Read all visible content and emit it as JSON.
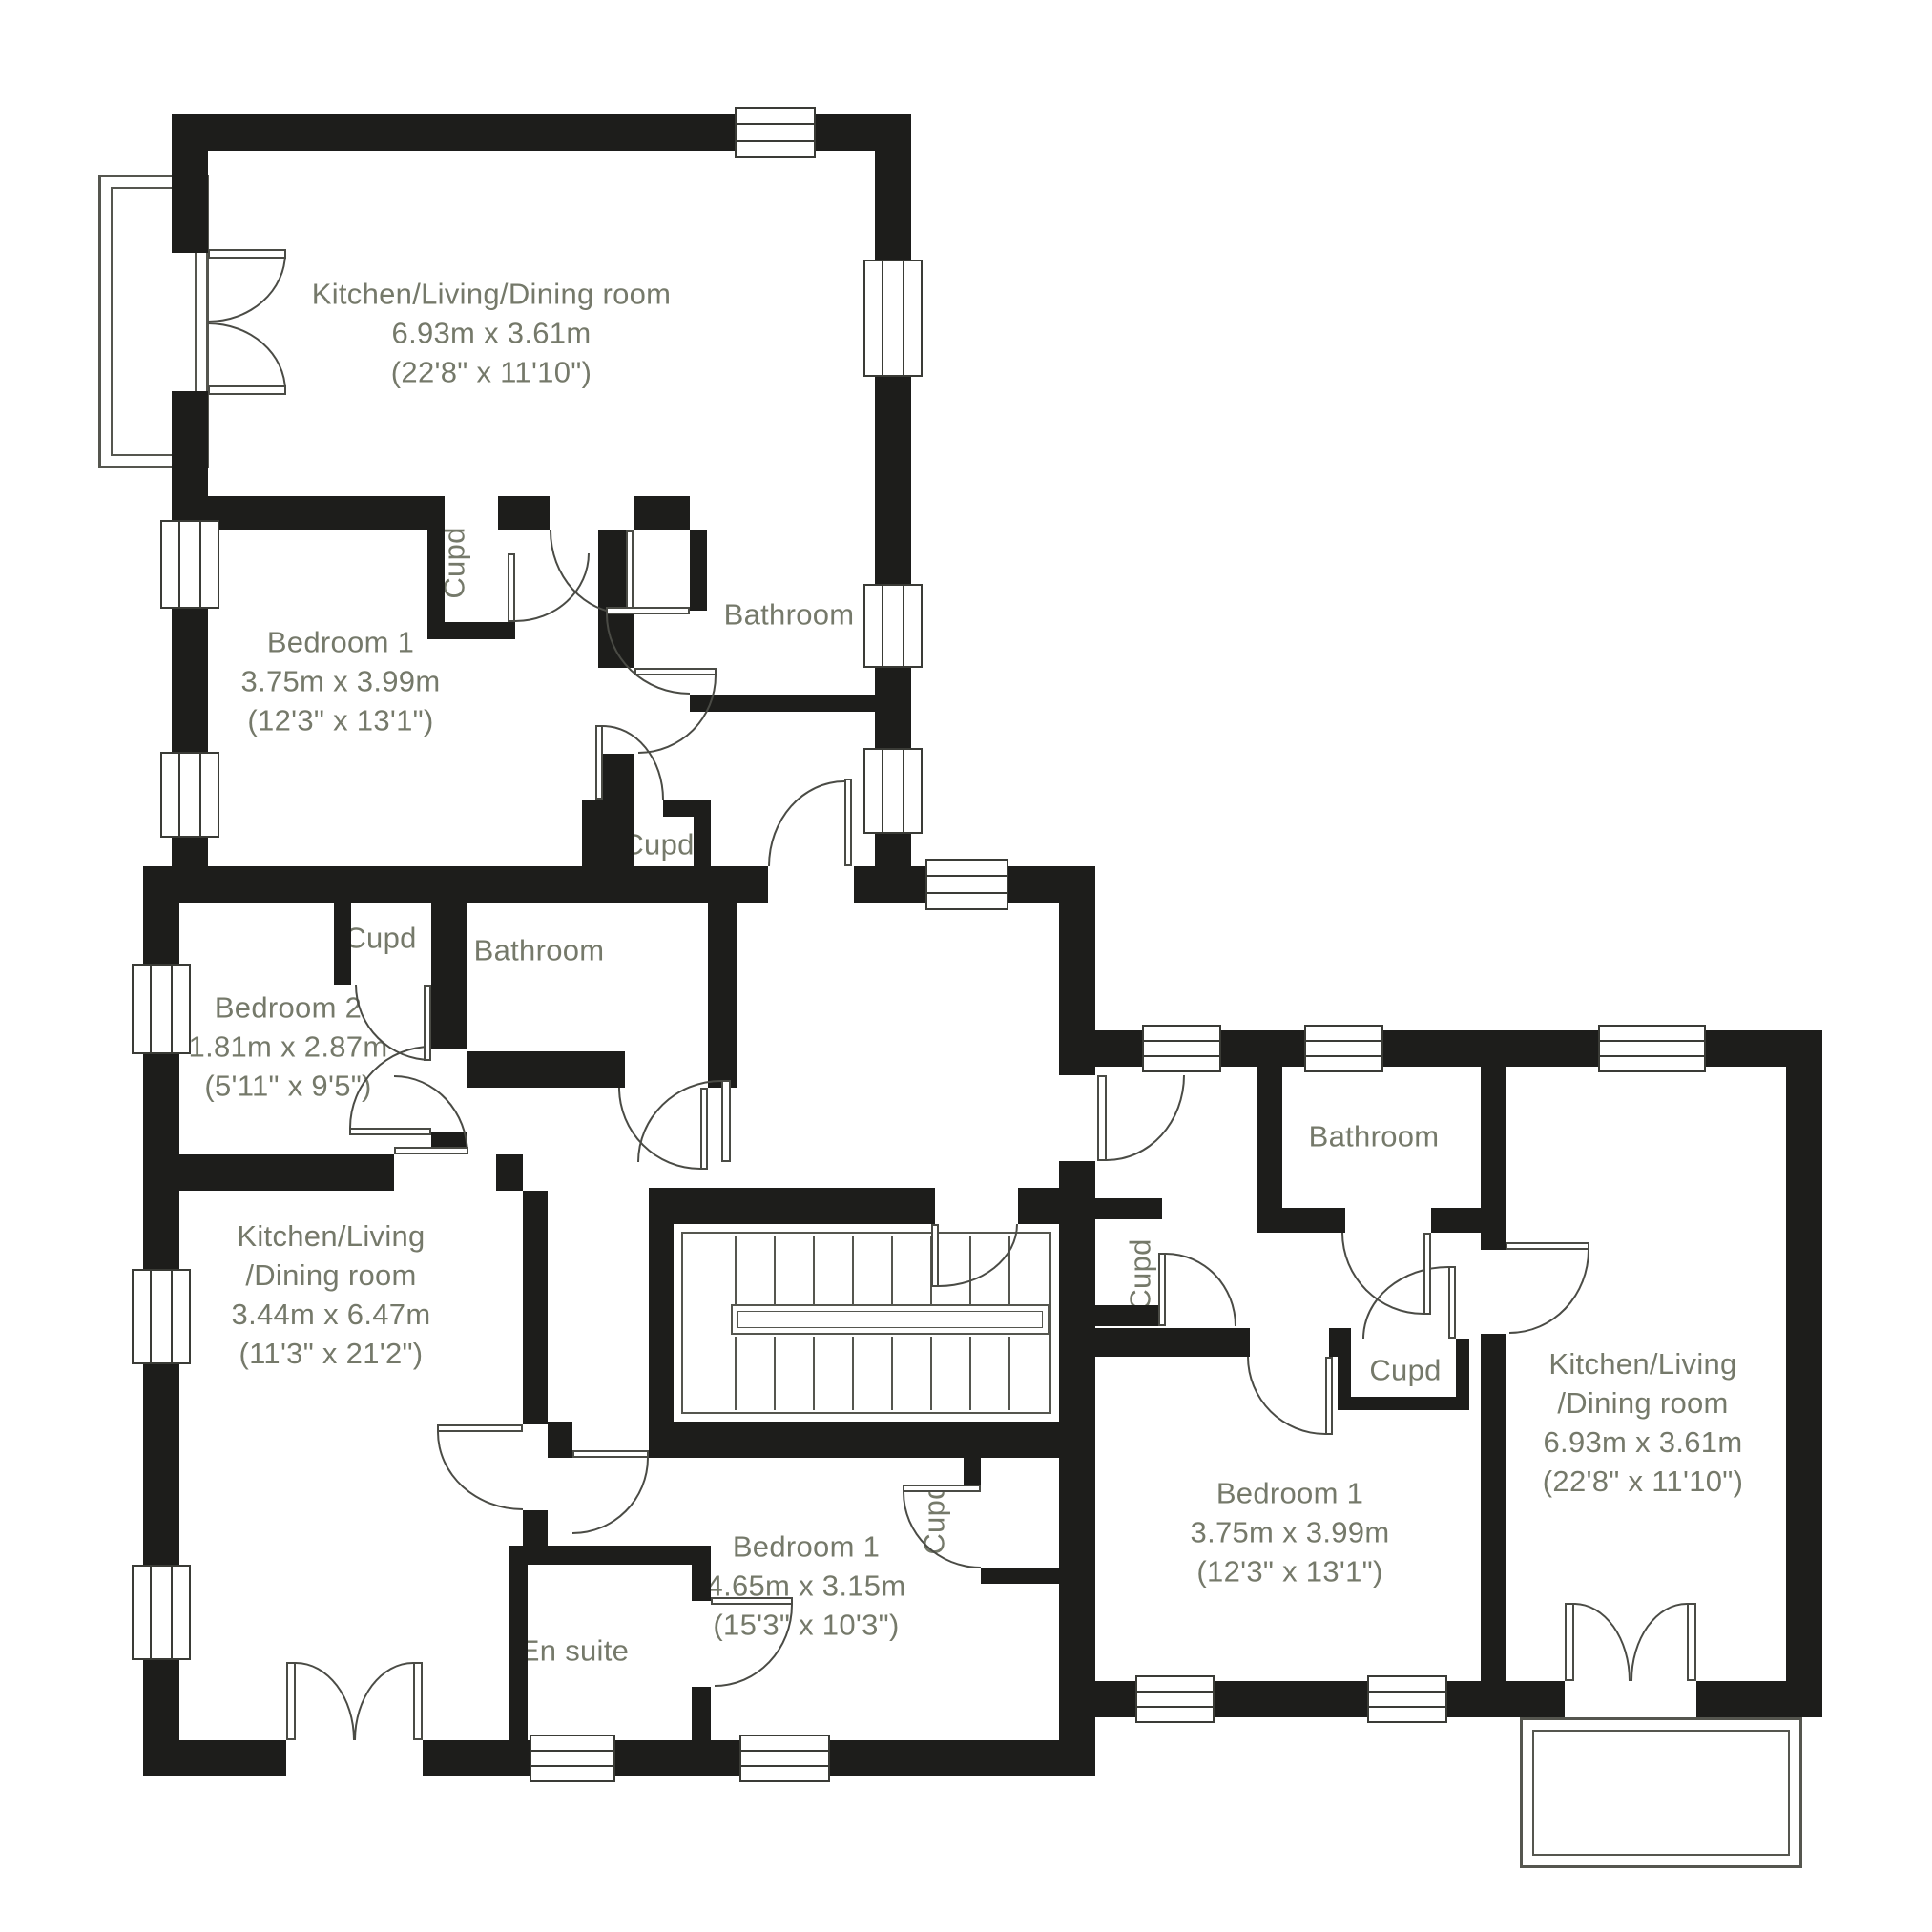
{
  "colors": {
    "wall": "#1d1d1b",
    "line": "#55564f",
    "text": "#75796a"
  },
  "rooms": {
    "kitchen_a": {
      "name": "Kitchen/Living/Dining room",
      "metric": "6.93m x 3.61m",
      "imperial": "(22'8\" x 11'10\")"
    },
    "bedroom1_a": {
      "name": "Bedroom 1",
      "metric": "3.75m x 3.99m",
      "imperial": "(12'3\" x 13'1\")"
    },
    "cupd_a1": {
      "name": "Cupd"
    },
    "bathroom_a": {
      "name": "Bathroom"
    },
    "cupd_a2": {
      "name": "Cupd"
    },
    "cupd_b1": {
      "name": "Cupd"
    },
    "bathroom_b": {
      "name": "Bathroom"
    },
    "bedroom2_b": {
      "name": "Bedroom 2",
      "metric": "1.81m x 2.87m",
      "imperial": "(5'11\" x 9'5\")"
    },
    "kitchen_b": {
      "name_line1": "Kitchen/Living",
      "name_line2": "/Dining room",
      "metric": "3.44m x 6.47m",
      "imperial": "(11'3\" x 21'2\")"
    },
    "ensuite_b": {
      "name": "En suite"
    },
    "bedroom1_b": {
      "name": "Bedroom 1",
      "metric": "4.65m x 3.15m",
      "imperial": "(15'3\" x 10'3\")"
    },
    "cupd_b2": {
      "name": "Cupd"
    },
    "cupd_c1": {
      "name": "Cupd"
    },
    "bathroom_c": {
      "name": "Bathroom"
    },
    "cupd_c2": {
      "name": "Cupd"
    },
    "bedroom1_c": {
      "name": "Bedroom 1",
      "metric": "3.75m x 3.99m",
      "imperial": "(12'3\" x 13'1\")"
    },
    "kitchen_c": {
      "name_line1": "Kitchen/Living",
      "name_line2": "/Dining room",
      "metric": "6.93m x 3.61m",
      "imperial": "(22'8\" x 11'10\")"
    }
  }
}
